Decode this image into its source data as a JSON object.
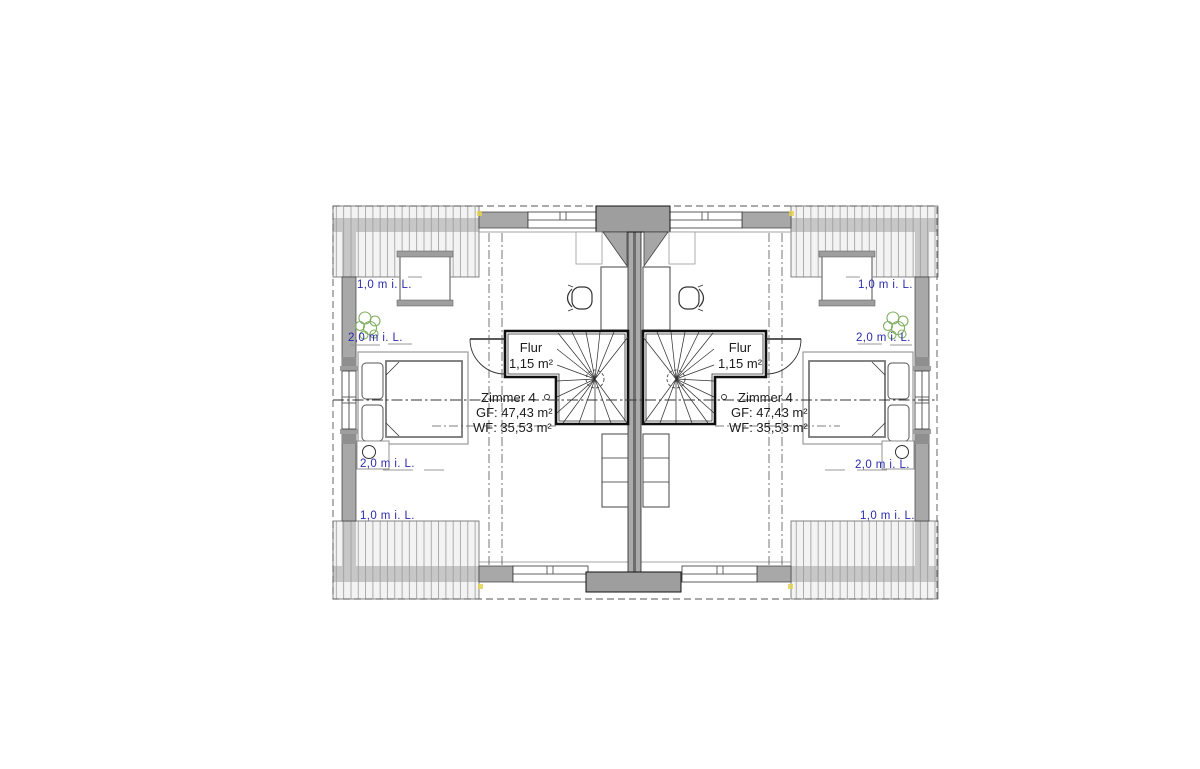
{
  "plan": {
    "title": "attic floor plan, semi-detached house, mirrored units",
    "units": {
      "left": {
        "hall": {
          "label": "Flur",
          "area": "1,15 m²"
        },
        "room": {
          "label": "Zimmer 4",
          "gross_area": "GF: 47,43 m²",
          "living_area": "WF: 35,53 m²"
        },
        "clearances": {
          "top_1m": "1,0 m i. L.",
          "top_2m": "2,0 m i. L.",
          "bottom_2m": "2,0 m i. L.",
          "bottom_1m": "1,0 m i. L."
        }
      },
      "right": {
        "hall": {
          "label": "Flur",
          "area": "1,15 m²"
        },
        "room": {
          "label": "Zimmer 4",
          "gross_area": "GF: 47,43 m²",
          "living_area": "WF: 35,53 m²"
        },
        "clearances": {
          "top_1m": "1,0 m i. L.",
          "top_2m": "2,0 m i. L.",
          "bottom_2m": "2,0 m i. L.",
          "bottom_1m": "1,0 m i. L."
        }
      }
    },
    "colors": {
      "dimension_blue": "#2b2bb0",
      "wall_gray": "#a8a8a8",
      "wall_dark_gray": "#9e9e9e",
      "hatch_line_gray": "#9a9a9a",
      "tree_green": "#7fae5f",
      "marker_yellow": "#e6d44f"
    }
  }
}
